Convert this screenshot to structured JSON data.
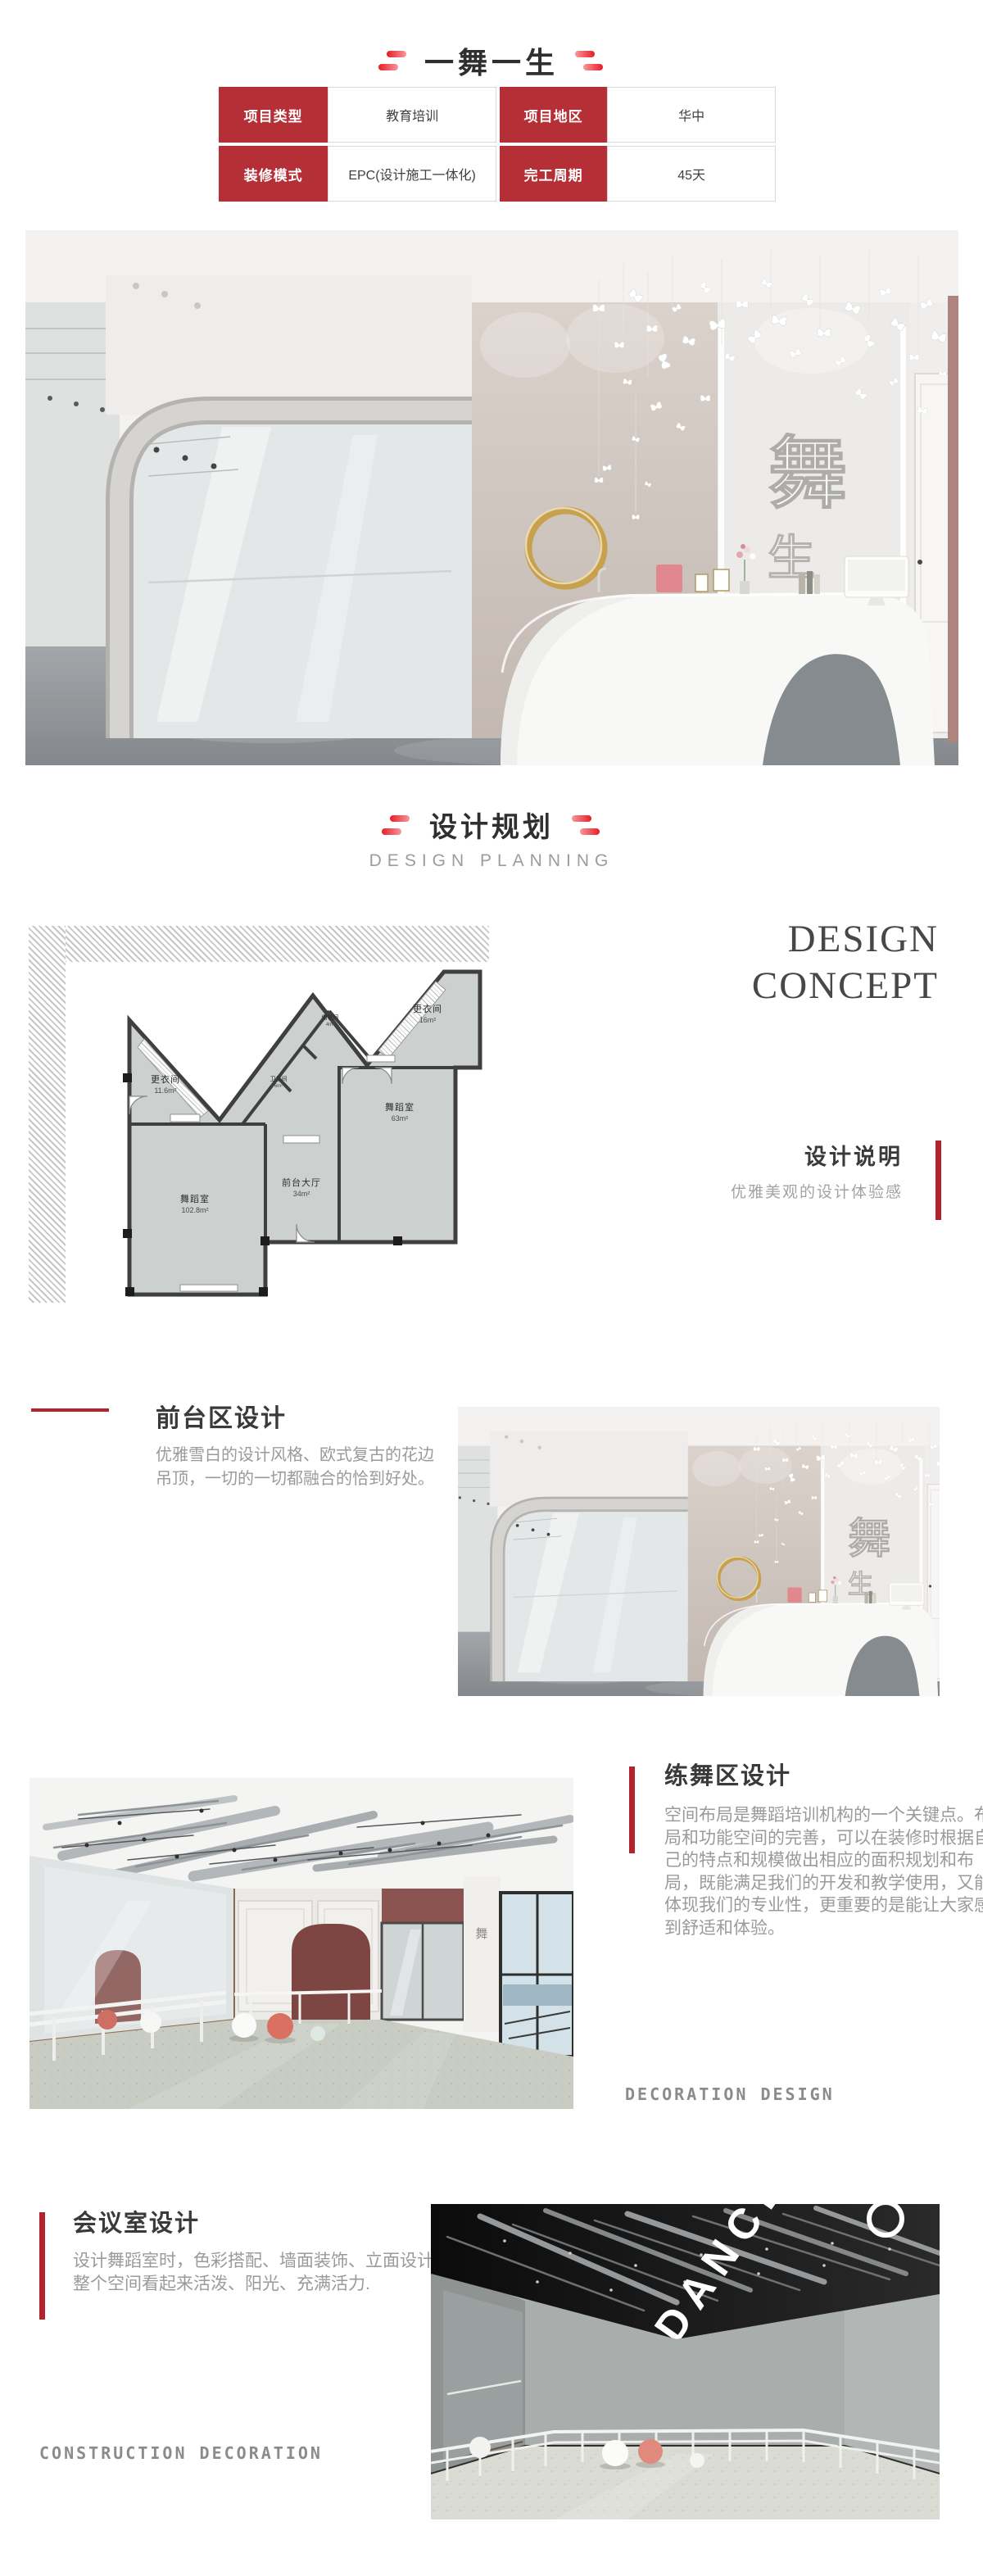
{
  "page": {
    "title": "一舞一生"
  },
  "colors": {
    "table_red": "#b52f37",
    "dash_red": "#e81c24",
    "bar_red": "#b2232c",
    "heading_dark": "#3a3a3a",
    "body_gray": "#9a9a9a",
    "caption_gray": "#8b8b8b"
  },
  "info_table": {
    "rows": [
      {
        "label1": "项目类型",
        "value1": "教育培训",
        "label2": "项目地区",
        "value2": "华中"
      },
      {
        "label1": "装修模式",
        "value1": "EPC(设计施工一体化)",
        "label2": "完工周期",
        "value2": "45天"
      }
    ]
  },
  "section_planning": {
    "title": "设计规划",
    "subtitle": "DESIGN PLANNING"
  },
  "design_concept": {
    "line1": "DESIGN",
    "line2": "CONCEPT",
    "label": "设计说明",
    "desc": "优雅美观的设计体验感"
  },
  "floor_plan": {
    "rooms": [
      {
        "name": "更衣间",
        "area": "11.6m²"
      },
      {
        "name": "舞蹈室",
        "area": "102.8m²"
      },
      {
        "name": "前台大厅",
        "area": "34m²"
      },
      {
        "name": "舞蹈室",
        "area": "63m²"
      },
      {
        "name": "更衣间",
        "area": "16m²"
      },
      {
        "name": "卫生间",
        "area": "6m²"
      },
      {
        "name": "储物间",
        "area": "4m²"
      }
    ]
  },
  "section_front_desk": {
    "title": "前台区设计",
    "body": "优雅雪白的设计风格、欧式复古的花边吊顶，一切的一切都融合的恰到好处。"
  },
  "section_practice": {
    "title": "练舞区设计",
    "body": "空间布局是舞蹈培训机构的一个关键点。布局和功能空间的完善，可以在装修时根据自己的特点和规模做出相应的面积规划和布局，既能满足我们的开发和教学使用，又能体现我们的专业性，更重要的是能让大家感到舒适和体验。",
    "caption": "DECORATION DESIGN"
  },
  "section_meeting": {
    "title": "会议室设计",
    "body": "设计舞蹈室时，色彩搭配、墙面装饰、立面设计要让整个空间看起来活泼、阳光、充满活力.",
    "caption": "CONSTRUCTION DECORATION"
  },
  "images": {
    "hero_logo": "舞",
    "hero_logo2": "生",
    "practice_sign": "舞",
    "meeting_ceiling_text": "DANCE"
  }
}
